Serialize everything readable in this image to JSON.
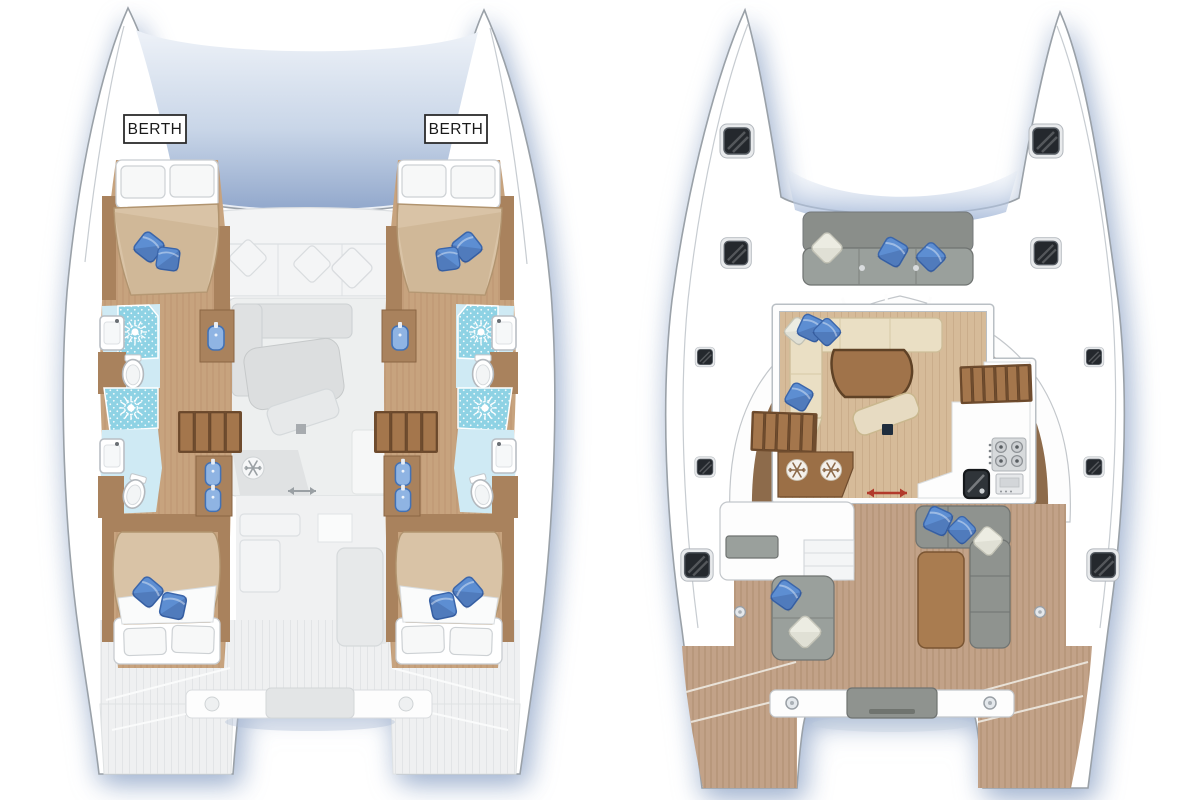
{
  "left_panel": {
    "name": "hull-deck-plan",
    "berth_labels": {
      "port": "BERTH",
      "starboard": "BERTH"
    }
  },
  "right_panel": {
    "name": "main-deck-plan"
  },
  "icons": {
    "shower": "sunburst",
    "toilet": "oval-bowl",
    "washbasin": "blue-basin",
    "fridge": "snowflake",
    "stove": "four-burner-hob",
    "oven": "oven-drawer",
    "sink": "dark-basin",
    "sliding_door": "red-double-arrow",
    "deck_hatch": "dark-rounded-square",
    "stairs": "wood-treads"
  },
  "palette": {
    "bg": "#ffffff",
    "hullFill": "#ffffff",
    "outline": "#9aa1a8",
    "outlineSoft": "#c7ccd1",
    "trampTop": "#eef2f8",
    "trampMid": "#c9d6e8",
    "trampBot": "#92a8cc",
    "wood": "#c7a37e",
    "woodLine": "#b18a64",
    "woodDark": "#a9825d",
    "duvet": "#d9c3a6",
    "duvetShade": "#c5aa87",
    "duvetEdge": "#b1946f",
    "pillowBlue": "#5d8ed2",
    "pillowBlueDark": "#3b66ab",
    "showerTile": "#8ed2e4",
    "bathFloor": "#cfeaf4",
    "basinBlue": "#8fb4e3",
    "basinBlueDark": "#4372b5",
    "brownBand": "#8d6b4b",
    "saloonFloor": "#d6bb99",
    "saloonFloorLine": "#c7aa87",
    "sofaCream": "#eadfc4",
    "sofaStroke": "#cdbd98",
    "tableBrown": "#a0734a",
    "tableEdge": "#5f4226",
    "stair": "#a4764c",
    "stairGap": "#6f4c2e",
    "graySeat": "#9aa09c",
    "graySeatEdge": "#6f7371",
    "teak": "#c2a288",
    "teakLine": "#ab8b6d",
    "hatch": "#24282d",
    "red": "#b23a2b"
  }
}
